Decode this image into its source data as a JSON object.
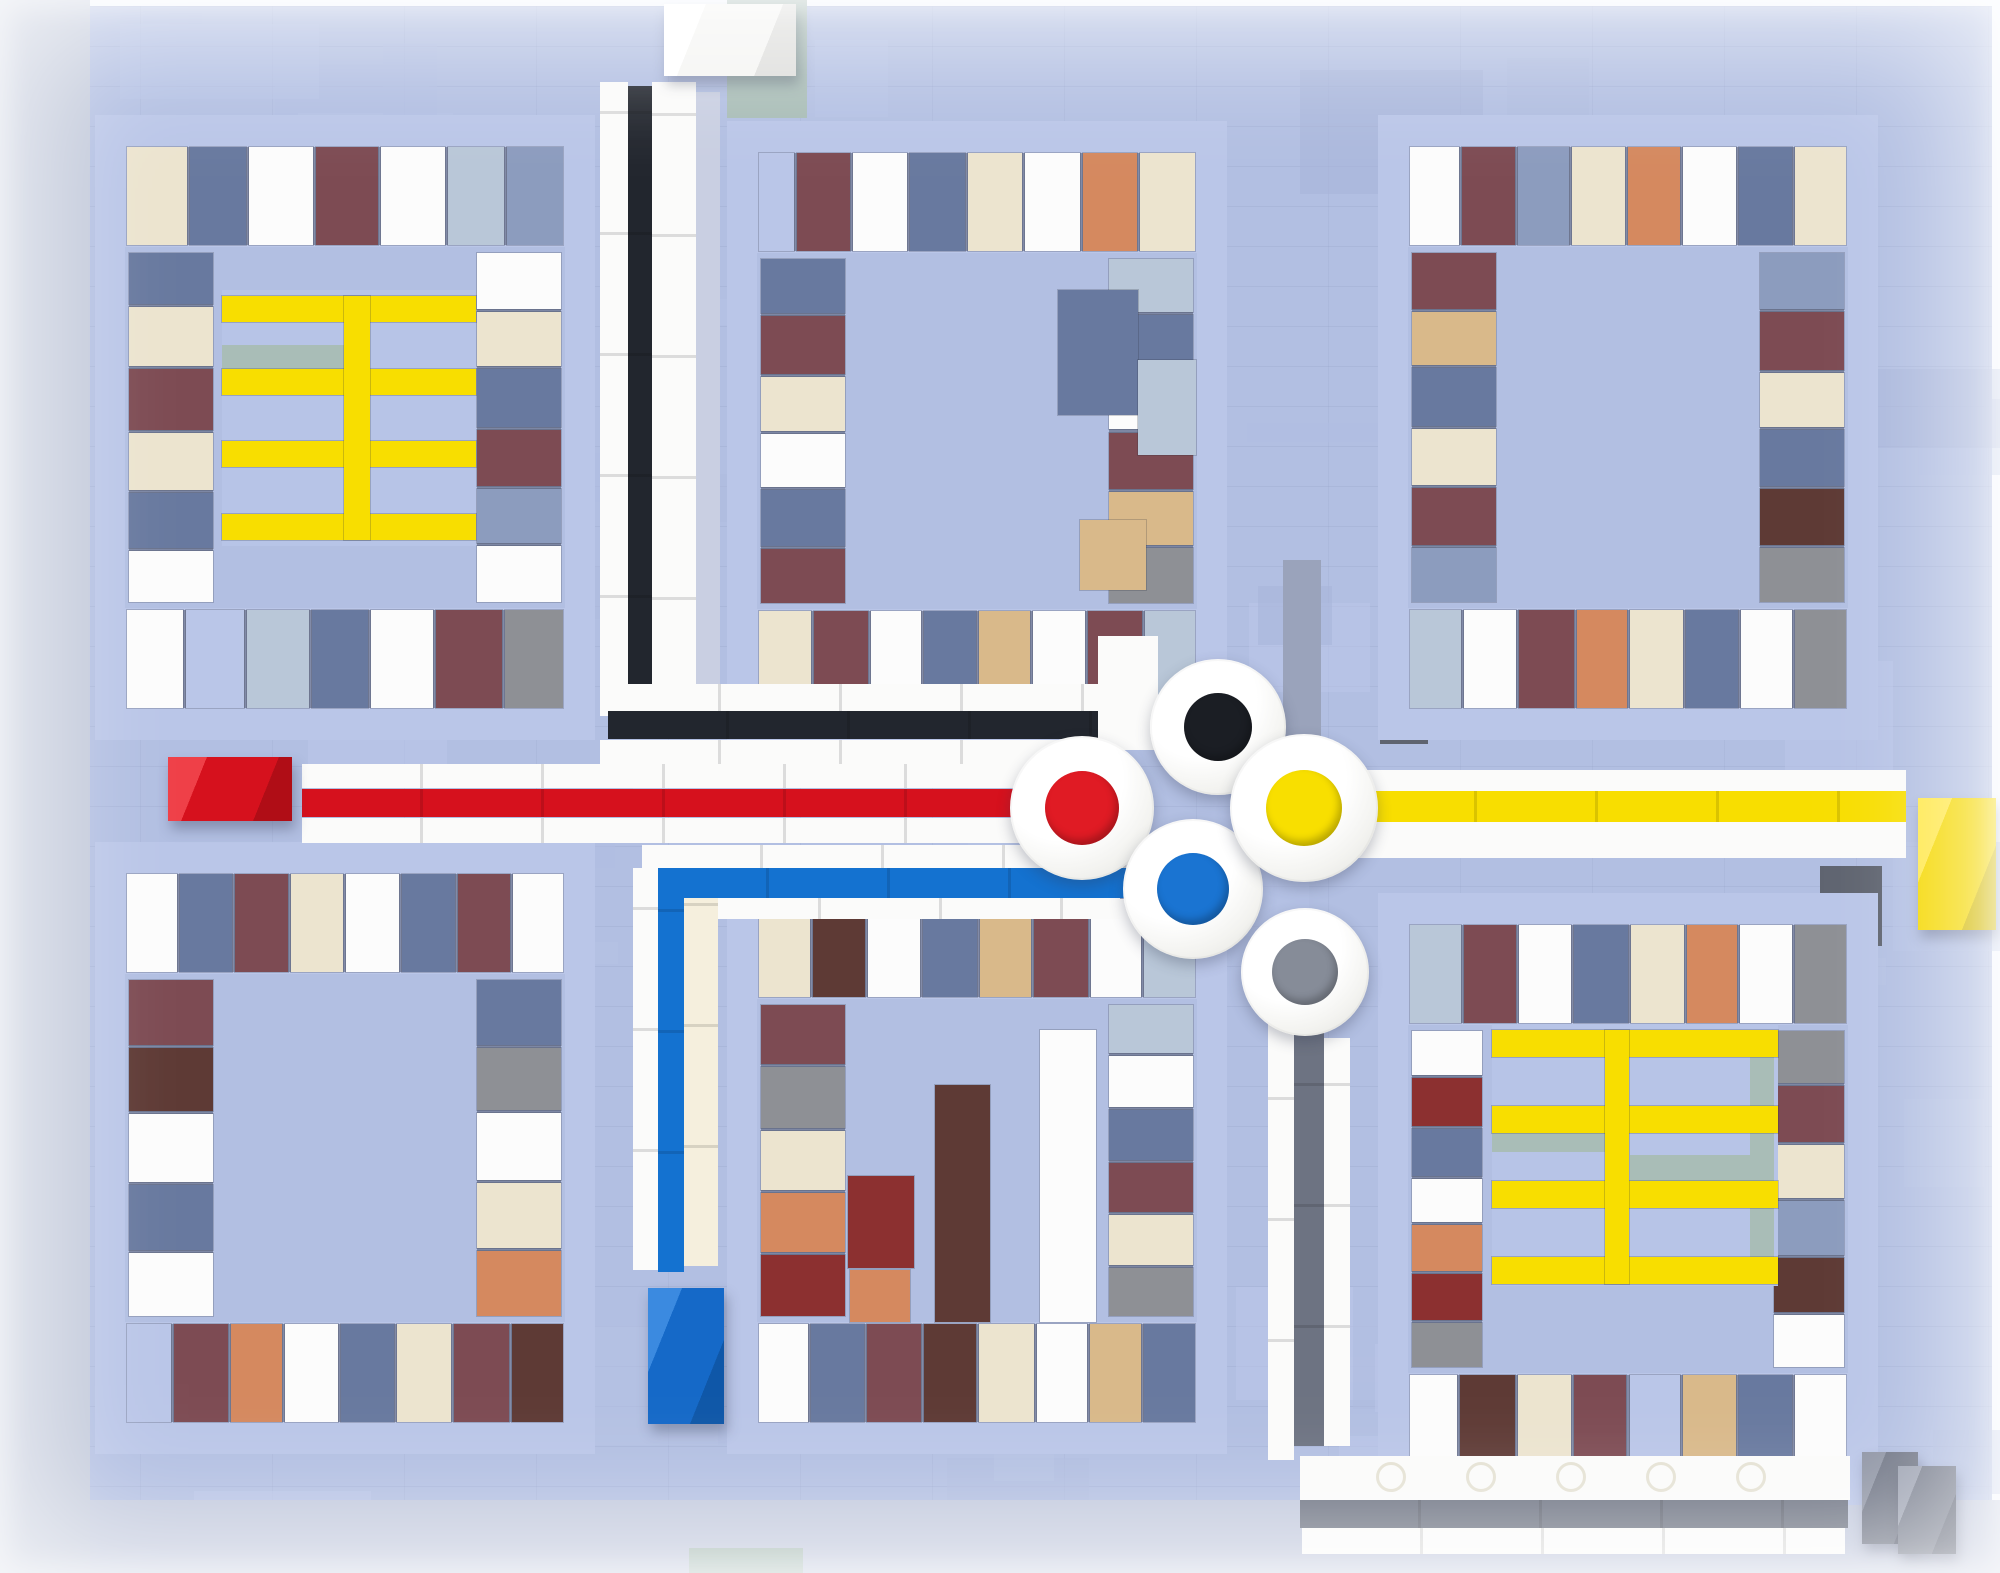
{
  "meta": {
    "type": "photograph",
    "subject": "LEGO tile mosaic of an abstract street map: six framed mosaic panels on a periwinkle baseplate, colored roads (black, red, yellow, blue, grey) with white edging meeting at a roundabout of five white discs with black, red, yellow, blue and grey centers, yellow ladder motifs in two panels, and 3D brick end-caps"
  },
  "canvas": {
    "w": 2000,
    "h": 1573,
    "baseplate": {
      "x": 8,
      "y": 6,
      "w": 1984,
      "h": 1561
    }
  },
  "tile_colors": {
    "P": "#b2bfe2",
    "F": "#bac6e8",
    "W": "#fcfcfc",
    "C": "#ece4cf",
    "T": "#d9b98a",
    "O": "#d5895f",
    "R": "#8c3030",
    "M": "#7d4b53",
    "B": "#5e3a35",
    "S": "#68799f",
    "L": "#8c9cbe",
    "G": "#8e9095",
    "D": "#5f6470",
    "A": "#a9bdb7",
    "E": "#b9c7d8",
    "U": "#9fb3c9"
  },
  "road_colors": {
    "white": "#fbfbfa",
    "black": "#22262e",
    "red": "#d6111d",
    "yellow": "#f8de00",
    "blue": "#1472d0",
    "roadgrey": "#6d7382",
    "cream_white": "#f5efdd",
    "lavender": "#c9cfe2"
  },
  "texture": {
    "seed": 11,
    "count": 70,
    "shades": [
      "#b7c3e5",
      "#aebbdf",
      "#bbc7e9",
      "#b0bde1",
      "#b6c2e4",
      "#a8b5d9"
    ]
  },
  "accents": [
    {
      "x": 0,
      "y": 0,
      "w": 90,
      "h": 1573,
      "c": "#c3cadb"
    },
    {
      "x": 727,
      "y": 0,
      "w": 80,
      "h": 118,
      "c": "A"
    },
    {
      "x": 1380,
      "y": 652,
      "w": 48,
      "h": 92,
      "c": "D"
    },
    {
      "x": 1820,
      "y": 866,
      "w": 62,
      "h": 80,
      "c": "D"
    },
    {
      "x": 1283,
      "y": 560,
      "w": 38,
      "h": 212,
      "c": "#9aa3bb"
    },
    {
      "x": 90,
      "y": 1500,
      "w": 1910,
      "h": 73,
      "c": "#c2c9dd"
    },
    {
      "x": 689,
      "y": 1548,
      "w": 114,
      "h": 25,
      "c": "A"
    }
  ],
  "panels": [
    {
      "name": "panel-top-left",
      "x": 95,
      "y": 115,
      "w": 500,
      "h": 625,
      "colw": 84,
      "top": [
        [
          "C",
          62
        ],
        [
          "S",
          58
        ],
        [
          "W",
          66
        ],
        [
          "M",
          64
        ],
        [
          "W",
          66
        ],
        [
          "E",
          58
        ],
        [
          "L",
          58
        ]
      ],
      "bottom": [
        [
          "W",
          58
        ],
        [
          "F",
          60
        ],
        [
          "E",
          64
        ],
        [
          "S",
          58
        ],
        [
          "W",
          64
        ],
        [
          "M",
          68
        ],
        [
          "G",
          60
        ]
      ],
      "left": [
        [
          "S",
          56
        ],
        [
          "C",
          64
        ],
        [
          "M",
          66
        ],
        [
          "C",
          62
        ],
        [
          "S",
          60
        ],
        [
          "W",
          56
        ]
      ],
      "right": [
        [
          "W",
          60
        ],
        [
          "C",
          58
        ],
        [
          "S",
          62
        ],
        [
          "M",
          60
        ],
        [
          "L",
          58
        ],
        [
          "W",
          60
        ]
      ],
      "accents": []
    },
    {
      "name": "panel-top-middle",
      "x": 727,
      "y": 121,
      "w": 500,
      "h": 620,
      "colw": 84,
      "top": [
        [
          "F",
          40
        ],
        [
          "M",
          60
        ],
        [
          "W",
          62
        ],
        [
          "S",
          62
        ],
        [
          "C",
          62
        ],
        [
          "W",
          62
        ],
        [
          "O",
          62
        ],
        [
          "C",
          62
        ]
      ],
      "bottom": [
        [
          "C",
          60
        ],
        [
          "M",
          62
        ],
        [
          "W",
          58
        ],
        [
          "S",
          60
        ],
        [
          "T",
          58
        ],
        [
          "W",
          60
        ],
        [
          "M",
          62
        ],
        [
          "E",
          58
        ]
      ],
      "left": [
        [
          "S",
          60
        ],
        [
          "M",
          64
        ],
        [
          "C",
          60
        ],
        [
          "W",
          58
        ],
        [
          "S",
          62
        ],
        [
          "M",
          60
        ]
      ],
      "right": [
        [
          "E",
          58
        ],
        [
          "S",
          62
        ],
        [
          "W",
          60
        ],
        [
          "M",
          62
        ],
        [
          "T",
          58
        ],
        [
          "G",
          60
        ]
      ],
      "accents": [
        {
          "x": 1058,
          "y": 290,
          "w": 80,
          "h": 125,
          "c": "S"
        },
        {
          "x": 1138,
          "y": 360,
          "w": 58,
          "h": 95,
          "c": "E"
        },
        {
          "x": 1080,
          "y": 520,
          "w": 66,
          "h": 70,
          "c": "T"
        }
      ]
    },
    {
      "name": "panel-top-right",
      "x": 1378,
      "y": 115,
      "w": 500,
      "h": 625,
      "colw": 84,
      "top": [
        [
          "W",
          56
        ],
        [
          "M",
          60
        ],
        [
          "L",
          58
        ],
        [
          "C",
          60
        ],
        [
          "O",
          60
        ],
        [
          "W",
          60
        ],
        [
          "S",
          60
        ],
        [
          "C",
          58
        ]
      ],
      "bottom": [
        [
          "E",
          58
        ],
        [
          "W",
          60
        ],
        [
          "M",
          62
        ],
        [
          "O",
          58
        ],
        [
          "C",
          60
        ],
        [
          "S",
          60
        ],
        [
          "W",
          58
        ],
        [
          "G",
          58
        ]
      ],
      "left": [
        [
          "M",
          60
        ],
        [
          "T",
          58
        ],
        [
          "S",
          62
        ],
        [
          "C",
          60
        ],
        [
          "M",
          62
        ],
        [
          "L",
          58
        ]
      ],
      "right": [
        [
          "L",
          60
        ],
        [
          "M",
          62
        ],
        [
          "C",
          58
        ],
        [
          "S",
          60
        ],
        [
          "B",
          60
        ],
        [
          "G",
          58
        ]
      ],
      "accents": []
    },
    {
      "name": "panel-bottom-left",
      "x": 95,
      "y": 842,
      "w": 500,
      "h": 612,
      "colw": 84,
      "top": [
        [
          "W",
          58
        ],
        [
          "S",
          60
        ],
        [
          "M",
          62
        ],
        [
          "C",
          60
        ],
        [
          "W",
          62
        ],
        [
          "S",
          62
        ],
        [
          "M",
          60
        ],
        [
          "W",
          58
        ]
      ],
      "bottom": [
        [
          "F",
          50
        ],
        [
          "M",
          60
        ],
        [
          "O",
          58
        ],
        [
          "W",
          60
        ],
        [
          "S",
          60
        ],
        [
          "C",
          60
        ],
        [
          "M",
          62
        ],
        [
          "B",
          58
        ]
      ],
      "left": [
        [
          "M",
          62
        ],
        [
          "B",
          60
        ],
        [
          "W",
          64
        ],
        [
          "S",
          62
        ],
        [
          "W",
          60
        ]
      ],
      "right": [
        [
          "S",
          60
        ],
        [
          "G",
          58
        ],
        [
          "W",
          62
        ],
        [
          "C",
          60
        ],
        [
          "O",
          60
        ]
      ],
      "accents": []
    },
    {
      "name": "panel-bottom-middle",
      "x": 727,
      "y": 867,
      "w": 500,
      "h": 587,
      "colw": 84,
      "top": [
        [
          "C",
          58
        ],
        [
          "B",
          60
        ],
        [
          "W",
          60
        ],
        [
          "S",
          62
        ],
        [
          "T",
          58
        ],
        [
          "M",
          62
        ],
        [
          "W",
          58
        ],
        [
          "E",
          58
        ]
      ],
      "bottom": [
        [
          "W",
          56
        ],
        [
          "S",
          60
        ],
        [
          "M",
          62
        ],
        [
          "B",
          60
        ],
        [
          "C",
          62
        ],
        [
          "W",
          58
        ],
        [
          "T",
          58
        ],
        [
          "S",
          58
        ]
      ],
      "left": [
        [
          "M",
          60
        ],
        [
          "G",
          62
        ],
        [
          "C",
          60
        ],
        [
          "O",
          60
        ],
        [
          "R",
          62
        ]
      ],
      "right": [
        [
          "E",
          58
        ],
        [
          "W",
          62
        ],
        [
          "S",
          60
        ],
        [
          "M",
          60
        ],
        [
          "C",
          60
        ],
        [
          "G",
          58
        ]
      ],
      "accents": [
        {
          "x": 848,
          "y": 1176,
          "w": 66,
          "h": 92,
          "c": "R"
        },
        {
          "x": 850,
          "y": 1270,
          "w": 60,
          "h": 52,
          "c": "O"
        },
        {
          "x": 935,
          "y": 1085,
          "w": 55,
          "h": 237,
          "c": "B"
        },
        {
          "x": 1040,
          "y": 1030,
          "w": 56,
          "h": 292,
          "c": "W"
        }
      ]
    },
    {
      "name": "panel-bottom-right",
      "x": 1378,
      "y": 893,
      "w": 500,
      "h": 612,
      "colw": 70,
      "top": [
        [
          "E",
          58
        ],
        [
          "M",
          60
        ],
        [
          "W",
          60
        ],
        [
          "S",
          62
        ],
        [
          "C",
          60
        ],
        [
          "O",
          58
        ],
        [
          "W",
          60
        ],
        [
          "G",
          58
        ]
      ],
      "bottom": [
        [
          "W",
          54
        ],
        [
          "B",
          62
        ],
        [
          "C",
          60
        ],
        [
          "M",
          60
        ],
        [
          "F",
          58
        ],
        [
          "T",
          60
        ],
        [
          "S",
          60
        ],
        [
          "W",
          58
        ]
      ],
      "left": [
        [
          "W",
          58
        ],
        [
          "R",
          64
        ],
        [
          "S",
          62
        ],
        [
          "W",
          58
        ],
        [
          "O",
          60
        ],
        [
          "R",
          62
        ],
        [
          "G",
          58
        ]
      ],
      "right": [
        [
          "G",
          58
        ],
        [
          "M",
          62
        ],
        [
          "C",
          60
        ],
        [
          "L",
          60
        ],
        [
          "B",
          60
        ],
        [
          "W",
          58
        ]
      ],
      "accents": []
    }
  ],
  "ladders": [
    {
      "name": "yellow-ladder-top-left",
      "x": 222,
      "y": 290,
      "w": 254,
      "h": 256,
      "bars_y": [
        296,
        369,
        441,
        514
      ],
      "bar_h": 26,
      "vx": 344,
      "vw": 26,
      "extras": [
        {
          "x": 222,
          "y": 345,
          "w": 122,
          "h": 24,
          "c": "A"
        }
      ]
    },
    {
      "name": "yellow-ladder-bottom-right",
      "x": 1492,
      "y": 1024,
      "w": 286,
      "h": 262,
      "bars_y": [
        1030,
        1106,
        1181,
        1257
      ],
      "bar_h": 27,
      "vx": 1605,
      "vw": 24,
      "extras": [
        {
          "x": 1750,
          "y": 1030,
          "w": 24,
          "h": 254,
          "c": "A"
        },
        {
          "x": 1630,
          "y": 1155,
          "w": 120,
          "h": 27,
          "c": "A"
        },
        {
          "x": 1492,
          "y": 1126,
          "w": 113,
          "h": 26,
          "c": "A"
        }
      ]
    }
  ],
  "bars": [
    {
      "name": "north-road-white-left",
      "x": 600,
      "y": 82,
      "w": 28,
      "h": 634,
      "c": "white",
      "seam": "v"
    },
    {
      "name": "north-road-black-stripe",
      "x": 628,
      "y": 86,
      "w": 24,
      "h": 630,
      "c": "black",
      "seam": "v"
    },
    {
      "name": "north-road-white-right",
      "x": 652,
      "y": 82,
      "w": 44,
      "h": 636,
      "c": "white",
      "seam": "v"
    },
    {
      "name": "north-road-side-shadow",
      "x": 696,
      "y": 92,
      "w": 24,
      "h": 624,
      "c": "lavender"
    },
    {
      "name": "east-black-road-white-upper",
      "x": 600,
      "y": 684,
      "w": 522,
      "h": 27,
      "c": "white",
      "seam": "h"
    },
    {
      "name": "east-black-road-stripe",
      "x": 608,
      "y": 711,
      "w": 549,
      "h": 28,
      "c": "black",
      "seam": "h"
    },
    {
      "name": "east-black-road-white-lower",
      "x": 600,
      "y": 740,
      "w": 502,
      "h": 24,
      "c": "white",
      "seam": "h"
    },
    {
      "name": "west-red-road-white-upper",
      "x": 302,
      "y": 764,
      "w": 792,
      "h": 24,
      "c": "white",
      "seam": "h"
    },
    {
      "name": "west-red-road-stripe",
      "x": 302,
      "y": 789,
      "w": 762,
      "h": 28,
      "c": "red",
      "seam": "h"
    },
    {
      "name": "west-red-road-white-lower",
      "x": 302,
      "y": 818,
      "w": 768,
      "h": 25,
      "c": "white",
      "seam": "h"
    },
    {
      "name": "yellow-road-white-key",
      "x": 1296,
      "y": 770,
      "w": 610,
      "h": 88,
      "c": "white",
      "radius": "44px 0 0 44px"
    },
    {
      "name": "east-yellow-road-stripe",
      "x": 1356,
      "y": 791,
      "w": 550,
      "h": 31,
      "c": "yellow",
      "seam": "h"
    },
    {
      "name": "south-blue-road-white-upper",
      "x": 642,
      "y": 845,
      "w": 496,
      "h": 23,
      "c": "white",
      "seam": "h"
    },
    {
      "name": "south-blue-road-stripe-h",
      "x": 648,
      "y": 868,
      "w": 480,
      "h": 30,
      "c": "blue",
      "seam": "h"
    },
    {
      "name": "south-blue-road-white-lower",
      "x": 700,
      "y": 898,
      "w": 420,
      "h": 21,
      "c": "white",
      "seam": "h"
    },
    {
      "name": "south-blue-road-white-v",
      "x": 633,
      "y": 868,
      "w": 25,
      "h": 402,
      "c": "white",
      "seam": "v"
    },
    {
      "name": "south-blue-road-stripe-v",
      "x": 658,
      "y": 868,
      "w": 26,
      "h": 404,
      "c": "blue",
      "seam": "v"
    },
    {
      "name": "south-blue-road-cream-v",
      "x": 684,
      "y": 898,
      "w": 34,
      "h": 368,
      "c": "cream_white",
      "seam": "v"
    },
    {
      "name": "cluster-white-connector",
      "x": 1098,
      "y": 636,
      "w": 60,
      "h": 114,
      "c": "white"
    },
    {
      "name": "south-grey-road-white-left",
      "x": 1268,
      "y": 1000,
      "w": 26,
      "h": 460,
      "c": "white",
      "seam": "v"
    },
    {
      "name": "south-grey-road-stripe",
      "x": 1294,
      "y": 1004,
      "w": 30,
      "h": 442,
      "c": "roadgrey",
      "seam": "v"
    },
    {
      "name": "south-grey-road-white-right",
      "x": 1324,
      "y": 1038,
      "w": 26,
      "h": 408,
      "c": "white",
      "seam": "v"
    },
    {
      "name": "se-grey-road-white-plate",
      "x": 1300,
      "y": 1456,
      "w": 550,
      "h": 44,
      "c": "white",
      "studs": [
        1390,
        1480,
        1570,
        1660,
        1750
      ]
    },
    {
      "name": "se-grey-road-stripe",
      "x": 1300,
      "y": 1500,
      "w": 548,
      "h": 28,
      "c": "roadgrey",
      "seam": "h"
    },
    {
      "name": "se-grey-road-white-lower",
      "x": 1302,
      "y": 1528,
      "w": 543,
      "h": 26,
      "c": "white",
      "seam": "h"
    }
  ],
  "caps": [
    {
      "name": "red-end-cap",
      "x": 168,
      "y": 757,
      "w": 124,
      "h": 64,
      "light": "#ef4048",
      "main": "#d6111d",
      "dark": "#b00d16"
    },
    {
      "name": "yellow-end-cap",
      "x": 1918,
      "y": 798,
      "w": 78,
      "h": 132,
      "light": "#ffe84a",
      "main": "#f5d800",
      "dark": "#d4ba00"
    },
    {
      "name": "blue-end-cap",
      "x": 648,
      "y": 1288,
      "w": 76,
      "h": 136,
      "light": "#3b8ae0",
      "main": "#1569c8",
      "dark": "#0f57a8"
    },
    {
      "name": "white-end-cap",
      "x": 664,
      "y": 4,
      "w": 132,
      "h": 72,
      "light": "#ffffff",
      "main": "#f5f5f3",
      "dark": "#dededc"
    },
    {
      "name": "grey-end-cap-rear",
      "x": 1862,
      "y": 1452,
      "w": 56,
      "h": 92,
      "light": "#8d93a3",
      "main": "#6e7484",
      "dark": "#585e6e"
    },
    {
      "name": "grey-end-cap-front",
      "x": 1898,
      "y": 1466,
      "w": 58,
      "h": 88,
      "light": "#9aa0b0",
      "main": "#767c8c",
      "dark": "#606676"
    }
  ],
  "discs": [
    {
      "name": "roundabout-disc-black",
      "cx": 1218,
      "cy": 727,
      "r": 68,
      "ir": 34,
      "c": "#1b1e24"
    },
    {
      "name": "roundabout-disc-red",
      "cx": 1082,
      "cy": 808,
      "r": 72,
      "ir": 37,
      "c": "#e01b24"
    },
    {
      "name": "roundabout-disc-blue",
      "cx": 1193,
      "cy": 889,
      "r": 70,
      "ir": 36,
      "c": "#1a74d2"
    },
    {
      "name": "roundabout-disc-grey",
      "cx": 1305,
      "cy": 972,
      "r": 64,
      "ir": 33,
      "c": "#868c98"
    },
    {
      "name": "roundabout-disc-yellow",
      "cx": 1304,
      "cy": 808,
      "r": 74,
      "ir": 38,
      "c": "#f8df00"
    }
  ]
}
